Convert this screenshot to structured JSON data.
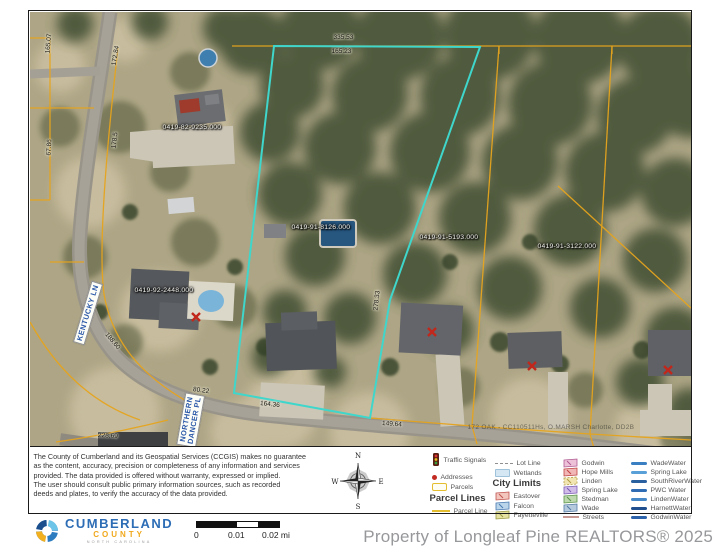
{
  "map": {
    "parcel_ids": [
      "0419-82-9235.000",
      "0419-91-8126.000",
      "0419-91-5193.000",
      "0419-91-3122.000",
      "0419-92-2448.000"
    ],
    "dimensions": [
      "165.07",
      "67.86",
      "172.84",
      "178.5",
      "188.60",
      "80.22",
      "228.69",
      "164.36",
      "149.64",
      "278.33",
      "335.53",
      "165.23"
    ],
    "streets": {
      "kentucky": "KENTUCKY LN",
      "northern_line1": "NORTHERN",
      "northern_line2": "DANCER PL"
    },
    "note": "172 OAK - CC110511Hs, O.MARSH Charlotte, DD2B",
    "colors": {
      "subject_highlight": "#3fd6cb",
      "parcel_line": "#e6a41d"
    }
  },
  "legend": {
    "col1": {
      "header": "Parcel Lines",
      "items": [
        {
          "icon": "traffic-signal-icon",
          "label": "Traffic Signals"
        },
        {
          "icon": "address-dot-icon",
          "label": "Addresses"
        },
        {
          "icon": "parcel-rect-icon",
          "label": "Parcels"
        }
      ],
      "sub_items": [
        {
          "icon": "parcel-line-icon",
          "label": "Parcel Line"
        }
      ]
    },
    "col2": {
      "header": "City Limits",
      "items": [
        {
          "icon": "lot-line-icon",
          "label": "Lot Line"
        },
        {
          "icon": "wetlands-icon",
          "label": "Wetlands"
        }
      ],
      "sub_items": [
        {
          "icon": "city-flag-icon",
          "label": "Eastover"
        },
        {
          "icon": "city-flag-icon",
          "label": "Falcon"
        },
        {
          "icon": "city-flag-icon",
          "label": "Fayetteville"
        }
      ]
    },
    "col3": {
      "items": [
        {
          "icon": "city-flag-icon",
          "label": "Godwin"
        },
        {
          "icon": "city-flag-icon",
          "label": "Hope Mills"
        },
        {
          "icon": "city-flag-icon",
          "label": "Linden"
        },
        {
          "icon": "city-flag-icon",
          "label": "Spring Lake"
        },
        {
          "icon": "city-flag-icon",
          "label": "Stedman"
        },
        {
          "icon": "city-flag-icon",
          "label": "Wade"
        },
        {
          "icon": "streets-line-icon",
          "label": "Streets"
        }
      ]
    },
    "col4": {
      "items": [
        {
          "icon": "water-line-icon",
          "label": "WadeWater"
        },
        {
          "icon": "water-line-icon",
          "label": "Spring Lake"
        },
        {
          "icon": "water-line-icon",
          "label": "SouthRiverWater"
        },
        {
          "icon": "water-line-icon",
          "label": "PWC Water"
        },
        {
          "icon": "water-line-icon",
          "label": "LindenWater"
        },
        {
          "icon": "water-line-icon",
          "label": "HarnettWater"
        },
        {
          "icon": "water-line-icon",
          "label": "GodwinWater"
        }
      ]
    }
  },
  "disclaimer": {
    "lines": [
      "The County of Cumberland and its Geospatial Services (CCGIS) makes no guarantee",
      "as the content, accuracy, precision or completeness of any information and services",
      "provided. The data provided is offered without warranty, expressed or implied.",
      "The user should consult public primary information sources, such as recorded",
      "deeds and plates, to verify the accuracy of the data provided."
    ]
  },
  "compass": {
    "n": "N",
    "e": "E",
    "s": "S",
    "w": "W"
  },
  "logo": {
    "name": "CUMBERLAND",
    "sub": "COUNTY",
    "tagline": "NORTH CAROLINA"
  },
  "scalebar": {
    "tick0": "0",
    "tick1": "0.01",
    "tick2": "0.02 mi"
  },
  "watermark": "Property of Longleaf Pine REALTORS® 2025"
}
